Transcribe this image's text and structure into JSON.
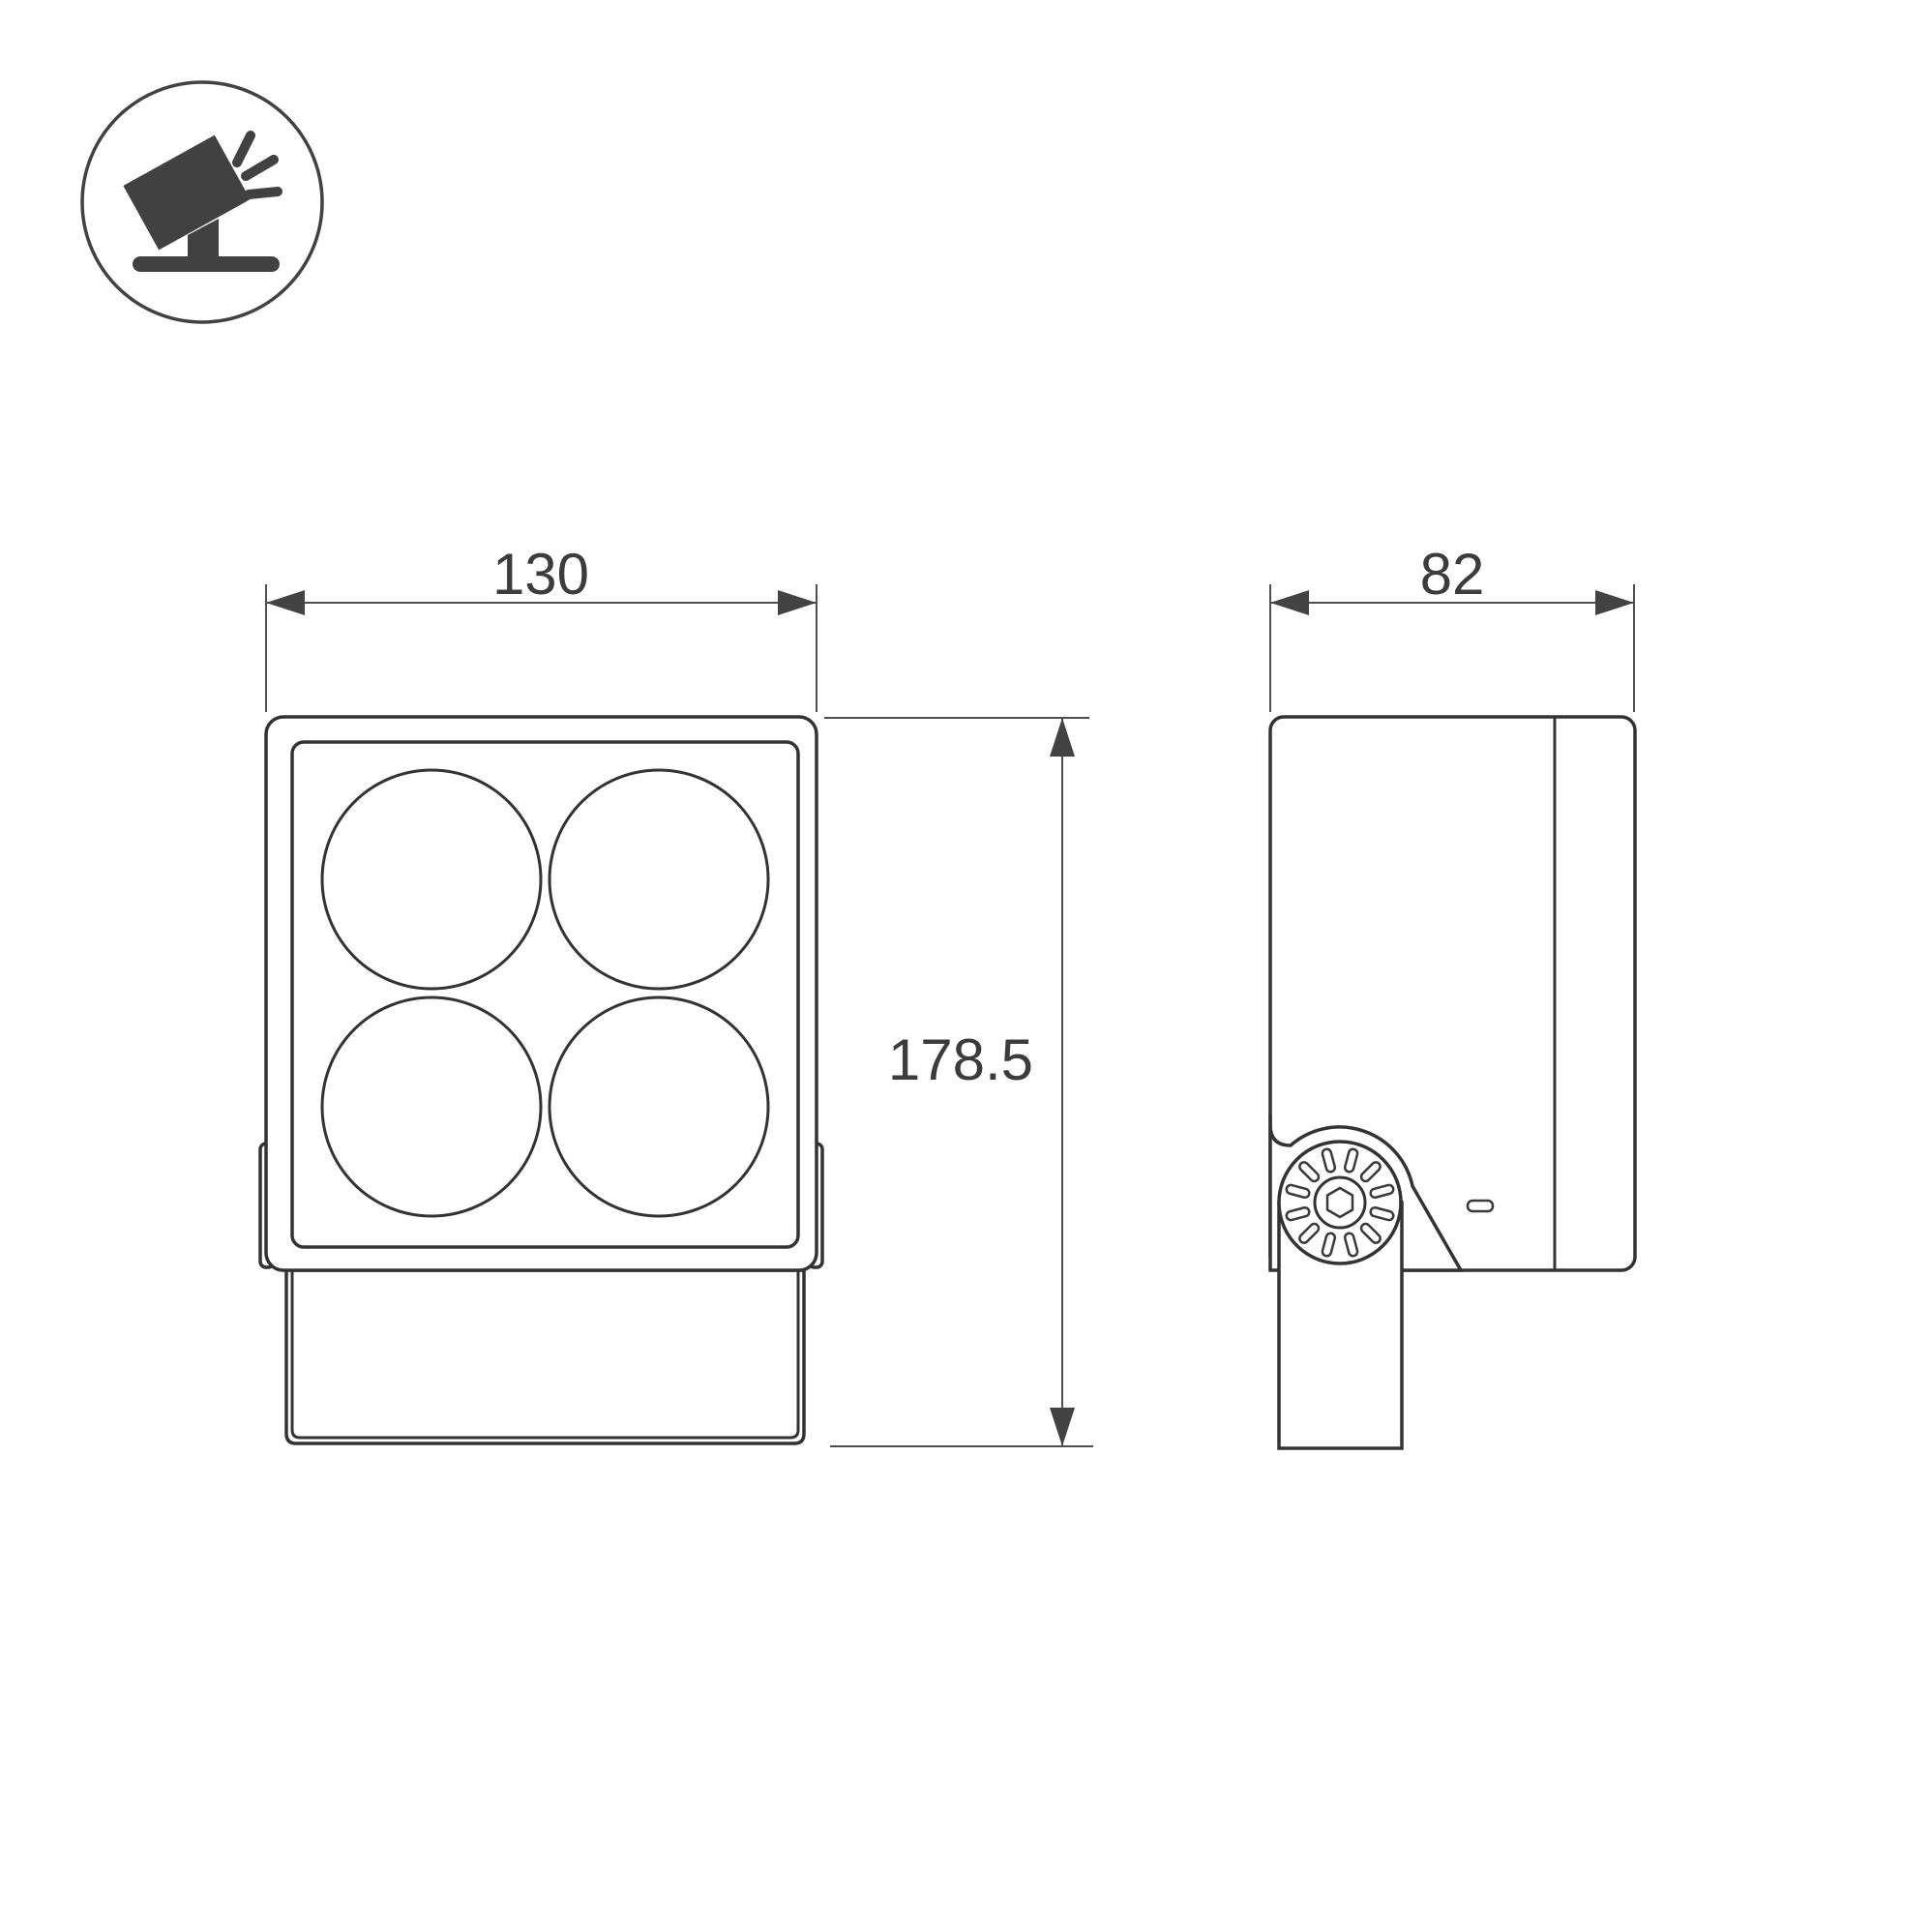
{
  "drawing": {
    "kind": "luminaire-dimension-drawing",
    "views": [
      "front-view",
      "side-view"
    ],
    "background_color": "#ffffff",
    "line_color": "#333333",
    "dimension_line_color": "#4f4f4f",
    "text_color": "#3c3c3c",
    "icon_color": "#414141"
  },
  "icons": {
    "product_pictogram": "floodlight-tilted-on-ground-icon"
  },
  "dimensions": {
    "width": "130",
    "depth": "82",
    "height": "178.5"
  },
  "front_view": {
    "lens_count": 4,
    "lens_layout": "2x2"
  },
  "side_view": {
    "features": [
      "adjustment-knob",
      "mounting-pole",
      "rear-fin-divider",
      "indicator-slot"
    ]
  }
}
